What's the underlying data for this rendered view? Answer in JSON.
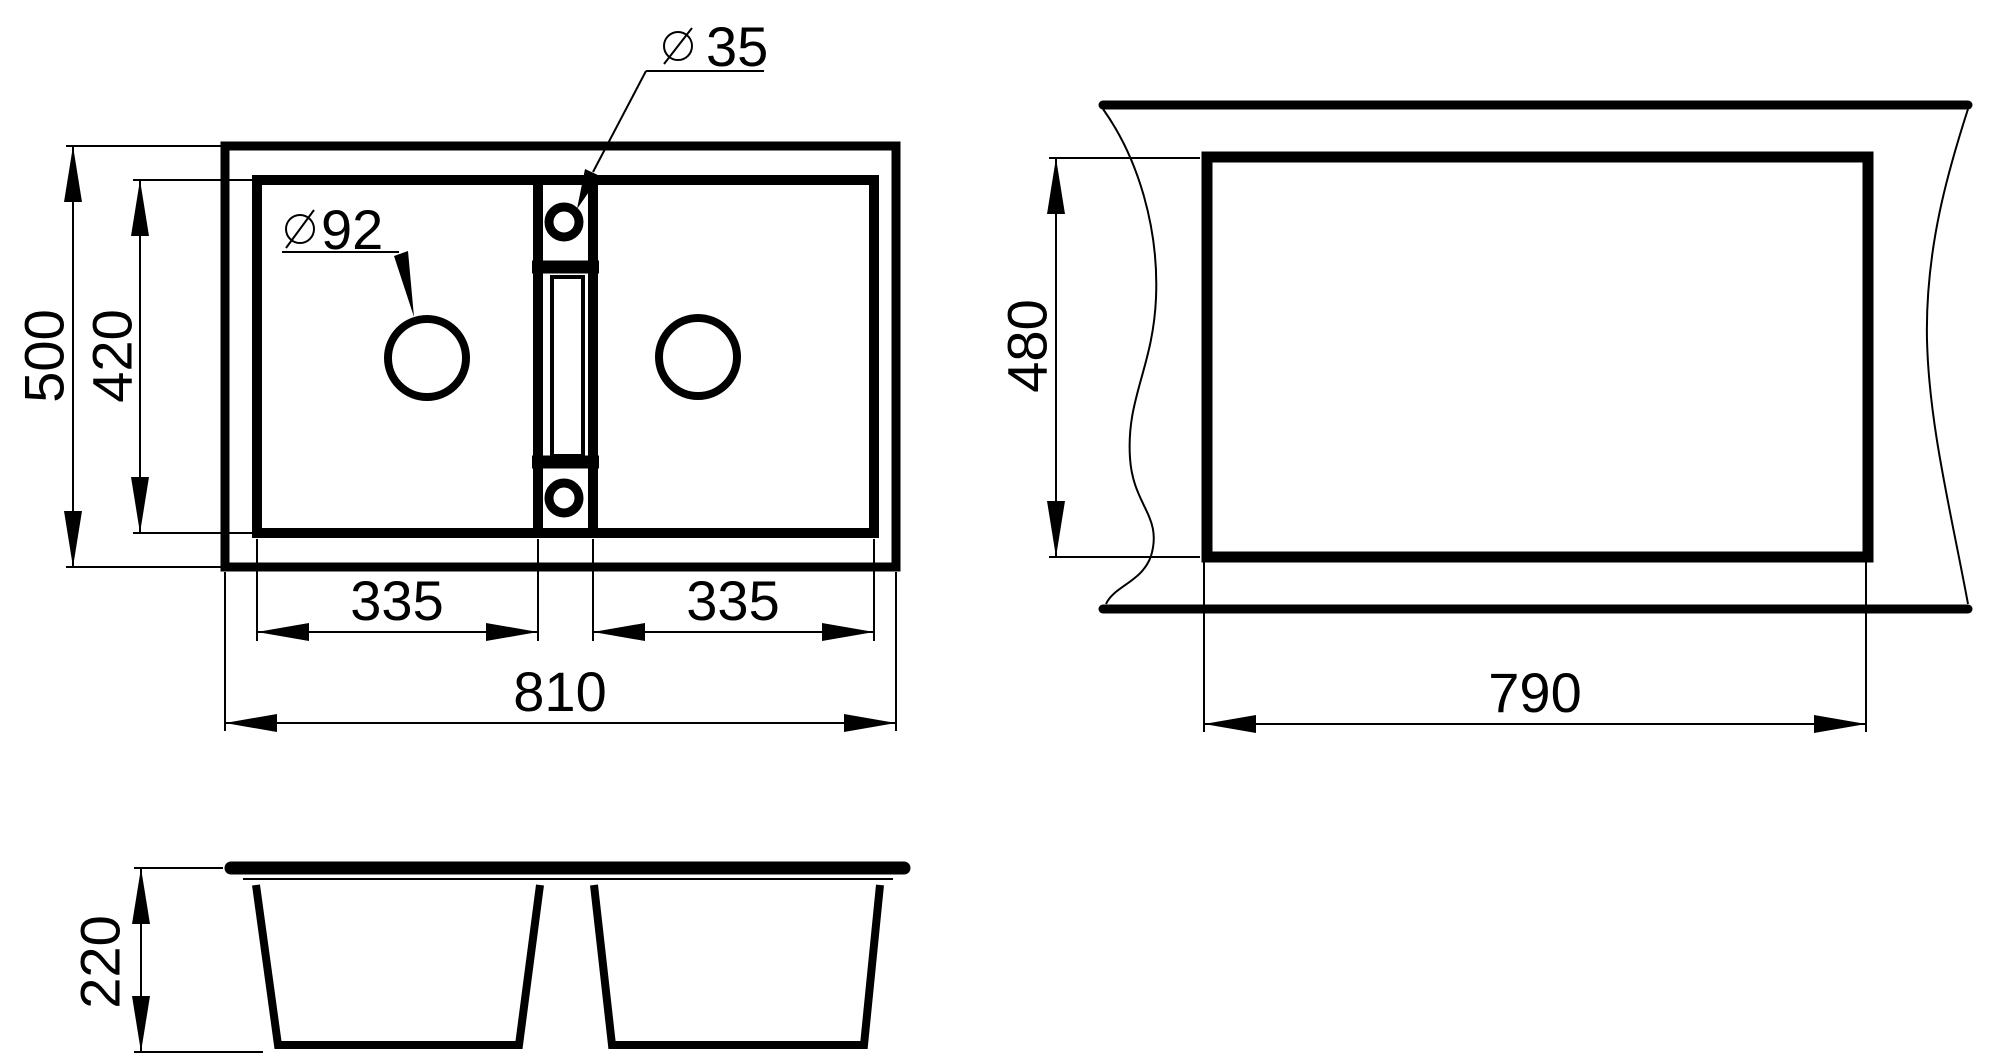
{
  "title": "Double-bowl sink dimension drawing",
  "colors": {
    "line": "#000000",
    "background": "#ffffff"
  },
  "views": {
    "top": {
      "dim_overall_height": "500",
      "dim_inner_height": "420",
      "dim_bowl1_width": "335",
      "dim_bowl2_width": "335",
      "dim_overall_width": "810",
      "label_drain_diameter": "92",
      "label_tap_hole_diameter": "35"
    },
    "cutout": {
      "dim_height": "480",
      "dim_width": "790"
    },
    "side": {
      "dim_depth": "220"
    }
  }
}
